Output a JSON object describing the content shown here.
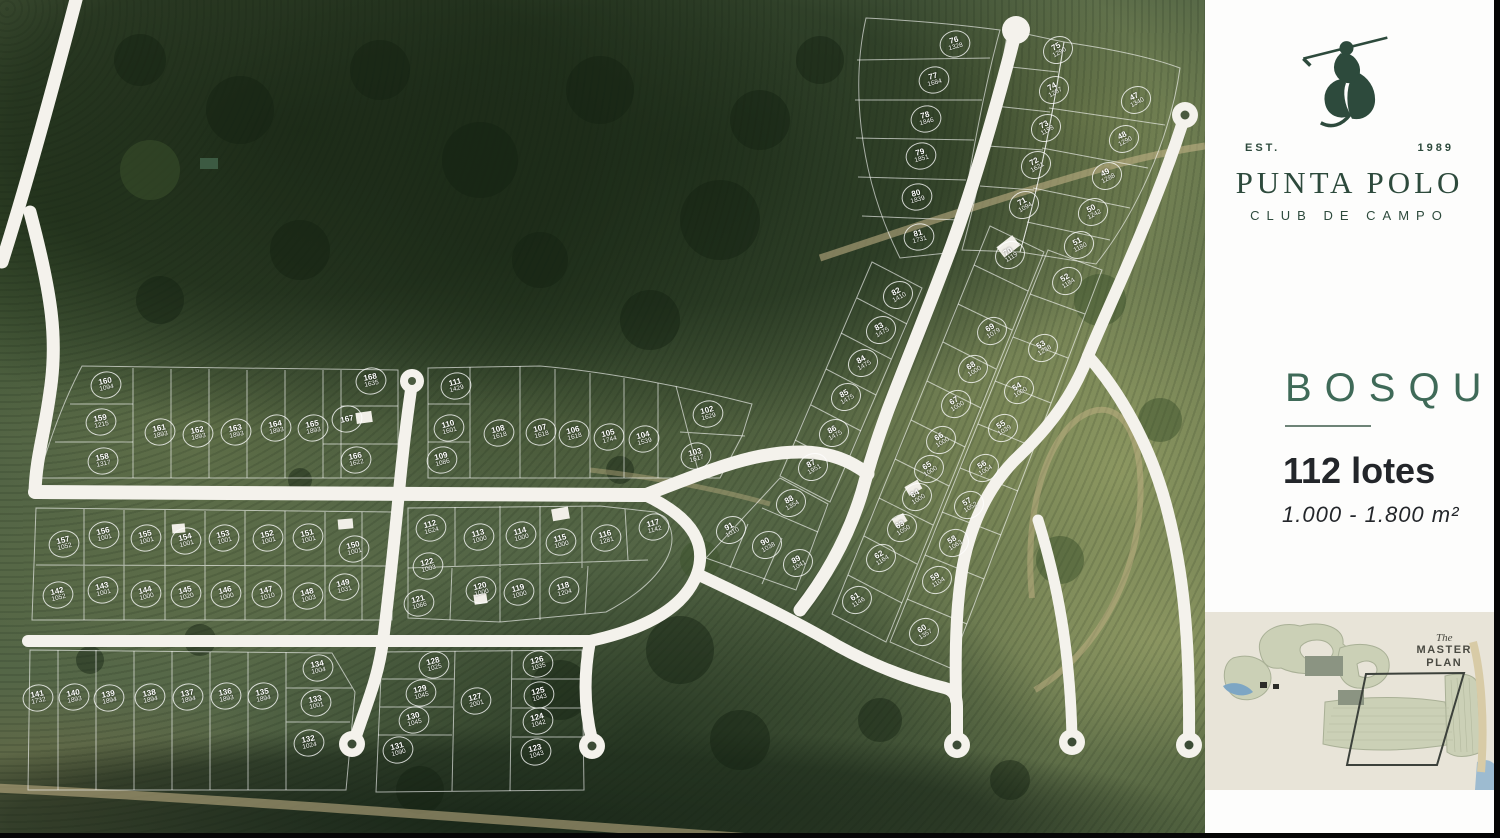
{
  "colors": {
    "brand_green": "#2d4a3c",
    "accent_green": "#3f6a58",
    "text_dark": "#23262a",
    "inset_beige": "#e8e4d8",
    "road_white": "#f4f2ec"
  },
  "sidebar": {
    "logo": {
      "est": "EST.",
      "year": "1989",
      "title": "PUNTA POLO",
      "subtitle": "CLUB DE CAMPO"
    },
    "section": {
      "name": "BOSQUE",
      "lots": "112 lotes",
      "range": "1.000 - 1.800 m²"
    },
    "master_plan": {
      "the": "The",
      "line1": "MASTER",
      "line2": "PLAN"
    }
  },
  "map": {
    "lots": [
      {
        "n": "76",
        "a": "1328",
        "x": 955,
        "y": 44,
        "r": -15
      },
      {
        "n": "77",
        "a": "1684",
        "x": 934,
        "y": 80,
        "r": -15
      },
      {
        "n": "78",
        "a": "1846",
        "x": 926,
        "y": 119,
        "r": -15
      },
      {
        "n": "79",
        "a": "1851",
        "x": 921,
        "y": 156,
        "r": -15
      },
      {
        "n": "80",
        "a": "1839",
        "x": 917,
        "y": 197,
        "r": -15
      },
      {
        "n": "81",
        "a": "1731",
        "x": 919,
        "y": 237,
        "r": -15
      },
      {
        "n": "75",
        "a": "1290",
        "x": 1058,
        "y": 50,
        "r": -30
      },
      {
        "n": "74",
        "a": "1287",
        "x": 1054,
        "y": 90,
        "r": -30
      },
      {
        "n": "73",
        "a": "1198",
        "x": 1046,
        "y": 128,
        "r": -30
      },
      {
        "n": "72",
        "a": "1621",
        "x": 1036,
        "y": 165,
        "r": -30
      },
      {
        "n": "71",
        "a": "1094",
        "x": 1024,
        "y": 205,
        "r": -30
      },
      {
        "n": "47",
        "a": "1340",
        "x": 1136,
        "y": 100,
        "r": -28
      },
      {
        "n": "48",
        "a": "1290",
        "x": 1124,
        "y": 139,
        "r": -28
      },
      {
        "n": "49",
        "a": "1288",
        "x": 1107,
        "y": 176,
        "r": -28
      },
      {
        "n": "50",
        "a": "1242",
        "x": 1093,
        "y": 212,
        "r": -28
      },
      {
        "n": "51",
        "a": "1180",
        "x": 1079,
        "y": 245,
        "r": -28
      },
      {
        "n": "52",
        "a": "1184",
        "x": 1067,
        "y": 281,
        "r": -32
      },
      {
        "n": "53",
        "a": "1238",
        "x": 1043,
        "y": 348,
        "r": -32
      },
      {
        "n": "54",
        "a": "1000",
        "x": 1019,
        "y": 390,
        "r": -32
      },
      {
        "n": "55",
        "a": "1039",
        "x": 1003,
        "y": 428,
        "r": -32
      },
      {
        "n": "56",
        "a": "1004",
        "x": 984,
        "y": 468,
        "r": -32
      },
      {
        "n": "57",
        "a": "1052",
        "x": 969,
        "y": 505,
        "r": -32
      },
      {
        "n": "58",
        "a": "1063",
        "x": 954,
        "y": 543,
        "r": -32
      },
      {
        "n": "59",
        "a": "1104",
        "x": 937,
        "y": 580,
        "r": -32
      },
      {
        "n": "60",
        "a": "1357",
        "x": 924,
        "y": 632,
        "r": -32
      },
      {
        "n": "70",
        "a": "1119",
        "x": 1010,
        "y": 255,
        "r": -32
      },
      {
        "n": "69",
        "a": "1079",
        "x": 992,
        "y": 331,
        "r": -32
      },
      {
        "n": "68",
        "a": "1000",
        "x": 973,
        "y": 369,
        "r": -32
      },
      {
        "n": "67",
        "a": "1000",
        "x": 956,
        "y": 404,
        "r": -32
      },
      {
        "n": "66",
        "a": "1000",
        "x": 941,
        "y": 440,
        "r": -32
      },
      {
        "n": "65",
        "a": "1000",
        "x": 929,
        "y": 469,
        "r": -32
      },
      {
        "n": "64",
        "a": "1000",
        "x": 917,
        "y": 497,
        "r": -32
      },
      {
        "n": "63",
        "a": "1050",
        "x": 902,
        "y": 528,
        "r": -32
      },
      {
        "n": "62",
        "a": "1164",
        "x": 881,
        "y": 558,
        "r": -32
      },
      {
        "n": "61",
        "a": "1146",
        "x": 857,
        "y": 600,
        "r": -32
      },
      {
        "n": "82",
        "a": "1410",
        "x": 898,
        "y": 295,
        "r": -30
      },
      {
        "n": "83",
        "a": "1475",
        "x": 881,
        "y": 330,
        "r": -30
      },
      {
        "n": "84",
        "a": "1475",
        "x": 863,
        "y": 363,
        "r": -30
      },
      {
        "n": "85",
        "a": "1475",
        "x": 846,
        "y": 397,
        "r": -30
      },
      {
        "n": "86",
        "a": "1475",
        "x": 834,
        "y": 433,
        "r": -30
      },
      {
        "n": "87",
        "a": "1951",
        "x": 813,
        "y": 467,
        "r": -30
      },
      {
        "n": "88",
        "a": "1354",
        "x": 791,
        "y": 503,
        "r": -30
      },
      {
        "n": "89",
        "a": "1041",
        "x": 798,
        "y": 563,
        "r": -30
      },
      {
        "n": "90",
        "a": "1038",
        "x": 767,
        "y": 545,
        "r": -30
      },
      {
        "n": "91",
        "a": "1010",
        "x": 731,
        "y": 530,
        "r": -30
      },
      {
        "n": "102",
        "a": "1629",
        "x": 708,
        "y": 414,
        "r": -15
      },
      {
        "n": "103",
        "a": "1617",
        "x": 696,
        "y": 456,
        "r": -15
      },
      {
        "n": "104",
        "a": "1539",
        "x": 644,
        "y": 439,
        "r": -15
      },
      {
        "n": "105",
        "a": "1744",
        "x": 609,
        "y": 437,
        "r": -15
      },
      {
        "n": "106",
        "a": "1618",
        "x": 574,
        "y": 434,
        "r": -15
      },
      {
        "n": "107",
        "a": "1618",
        "x": 541,
        "y": 432,
        "r": -15
      },
      {
        "n": "108",
        "a": "1618",
        "x": 499,
        "y": 433,
        "r": -15
      },
      {
        "n": "109",
        "a": "1086",
        "x": 442,
        "y": 460,
        "r": -15
      },
      {
        "n": "110",
        "a": "1601",
        "x": 449,
        "y": 428,
        "r": -15
      },
      {
        "n": "111",
        "a": "1429",
        "x": 456,
        "y": 386,
        "r": -15
      },
      {
        "n": "158",
        "a": "1317",
        "x": 103,
        "y": 461,
        "r": -12
      },
      {
        "n": "159",
        "a": "1215",
        "x": 101,
        "y": 422,
        "r": -12
      },
      {
        "n": "160",
        "a": "1094",
        "x": 106,
        "y": 385,
        "r": -12
      },
      {
        "n": "161",
        "a": "1893",
        "x": 160,
        "y": 432,
        "r": -12
      },
      {
        "n": "162",
        "a": "1893",
        "x": 198,
        "y": 434,
        "r": -12
      },
      {
        "n": "163",
        "a": "1893",
        "x": 236,
        "y": 432,
        "r": -12
      },
      {
        "n": "164",
        "a": "1893",
        "x": 276,
        "y": 428,
        "r": -12
      },
      {
        "n": "165",
        "a": "1893",
        "x": 313,
        "y": 428,
        "r": -12
      },
      {
        "n": "166",
        "a": "1622",
        "x": 356,
        "y": 460,
        "r": -12
      },
      {
        "n": "167",
        "a": "",
        "x": 347,
        "y": 419,
        "r": -12
      },
      {
        "n": "168",
        "a": "1635",
        "x": 371,
        "y": 381,
        "r": -12
      },
      {
        "n": "142",
        "a": "1052",
        "x": 58,
        "y": 595,
        "r": -14
      },
      {
        "n": "143",
        "a": "1001",
        "x": 103,
        "y": 590,
        "r": -14
      },
      {
        "n": "144",
        "a": "1000",
        "x": 146,
        "y": 594,
        "r": -14
      },
      {
        "n": "145",
        "a": "1020",
        "x": 186,
        "y": 594,
        "r": -14
      },
      {
        "n": "146",
        "a": "1000",
        "x": 226,
        "y": 594,
        "r": -14
      },
      {
        "n": "147",
        "a": "1010",
        "x": 267,
        "y": 594,
        "r": -14
      },
      {
        "n": "148",
        "a": "1003",
        "x": 308,
        "y": 596,
        "r": -14
      },
      {
        "n": "149",
        "a": "1031",
        "x": 344,
        "y": 587,
        "r": -14
      },
      {
        "n": "150",
        "a": "1001",
        "x": 354,
        "y": 549,
        "r": -14
      },
      {
        "n": "151",
        "a": "1001",
        "x": 308,
        "y": 537,
        "r": -14
      },
      {
        "n": "152",
        "a": "1001",
        "x": 268,
        "y": 538,
        "r": -14
      },
      {
        "n": "153",
        "a": "1001",
        "x": 224,
        "y": 538,
        "r": -14
      },
      {
        "n": "154",
        "a": "1001",
        "x": 186,
        "y": 541,
        "r": -14
      },
      {
        "n": "155",
        "a": "1001",
        "x": 146,
        "y": 538,
        "r": -14
      },
      {
        "n": "156",
        "a": "1001",
        "x": 104,
        "y": 535,
        "r": -14
      },
      {
        "n": "157",
        "a": "1052",
        "x": 64,
        "y": 544,
        "r": -14
      },
      {
        "n": "132",
        "a": "1024",
        "x": 309,
        "y": 743,
        "r": -12
      },
      {
        "n": "133",
        "a": "1001",
        "x": 316,
        "y": 703,
        "r": -12
      },
      {
        "n": "134",
        "a": "1004",
        "x": 318,
        "y": 668,
        "r": -12
      },
      {
        "n": "135",
        "a": "1894",
        "x": 263,
        "y": 696,
        "r": -12
      },
      {
        "n": "136",
        "a": "1893",
        "x": 226,
        "y": 696,
        "r": -12
      },
      {
        "n": "137",
        "a": "1894",
        "x": 188,
        "y": 697,
        "r": -12
      },
      {
        "n": "138",
        "a": "1894",
        "x": 150,
        "y": 697,
        "r": -12
      },
      {
        "n": "139",
        "a": "1894",
        "x": 109,
        "y": 698,
        "r": -12
      },
      {
        "n": "140",
        "a": "1893",
        "x": 74,
        "y": 697,
        "r": -12
      },
      {
        "n": "141",
        "a": "1732",
        "x": 38,
        "y": 698,
        "r": -12
      },
      {
        "n": "123",
        "a": "1043",
        "x": 536,
        "y": 752,
        "r": -15
      },
      {
        "n": "124",
        "a": "1042",
        "x": 538,
        "y": 721,
        "r": -15
      },
      {
        "n": "125",
        "a": "1043",
        "x": 539,
        "y": 695,
        "r": -15
      },
      {
        "n": "126",
        "a": "1035",
        "x": 538,
        "y": 664,
        "r": -15
      },
      {
        "n": "127",
        "a": "2001",
        "x": 476,
        "y": 701,
        "r": -15
      },
      {
        "n": "128",
        "a": "1025",
        "x": 434,
        "y": 665,
        "r": -15
      },
      {
        "n": "129",
        "a": "1045",
        "x": 421,
        "y": 693,
        "r": -15
      },
      {
        "n": "130",
        "a": "1045",
        "x": 414,
        "y": 720,
        "r": -15
      },
      {
        "n": "131",
        "a": "1090",
        "x": 398,
        "y": 750,
        "r": -15
      },
      {
        "n": "112",
        "a": "1624",
        "x": 431,
        "y": 528,
        "r": -15
      },
      {
        "n": "113",
        "a": "1000",
        "x": 479,
        "y": 537,
        "r": -15
      },
      {
        "n": "114",
        "a": "1000",
        "x": 521,
        "y": 535,
        "r": -15
      },
      {
        "n": "115",
        "a": "1000",
        "x": 561,
        "y": 542,
        "r": -15
      },
      {
        "n": "116",
        "a": "1281",
        "x": 606,
        "y": 538,
        "r": -15
      },
      {
        "n": "117",
        "a": "1142",
        "x": 654,
        "y": 527,
        "r": -15
      },
      {
        "n": "118",
        "a": "1204",
        "x": 564,
        "y": 590,
        "r": -15
      },
      {
        "n": "119",
        "a": "1000",
        "x": 519,
        "y": 592,
        "r": -15
      },
      {
        "n": "120",
        "a": "1000",
        "x": 481,
        "y": 590,
        "r": -15
      },
      {
        "n": "121",
        "a": "1066",
        "x": 419,
        "y": 603,
        "r": -15
      },
      {
        "n": "122",
        "a": "1003",
        "x": 428,
        "y": 566,
        "r": -15
      }
    ]
  }
}
